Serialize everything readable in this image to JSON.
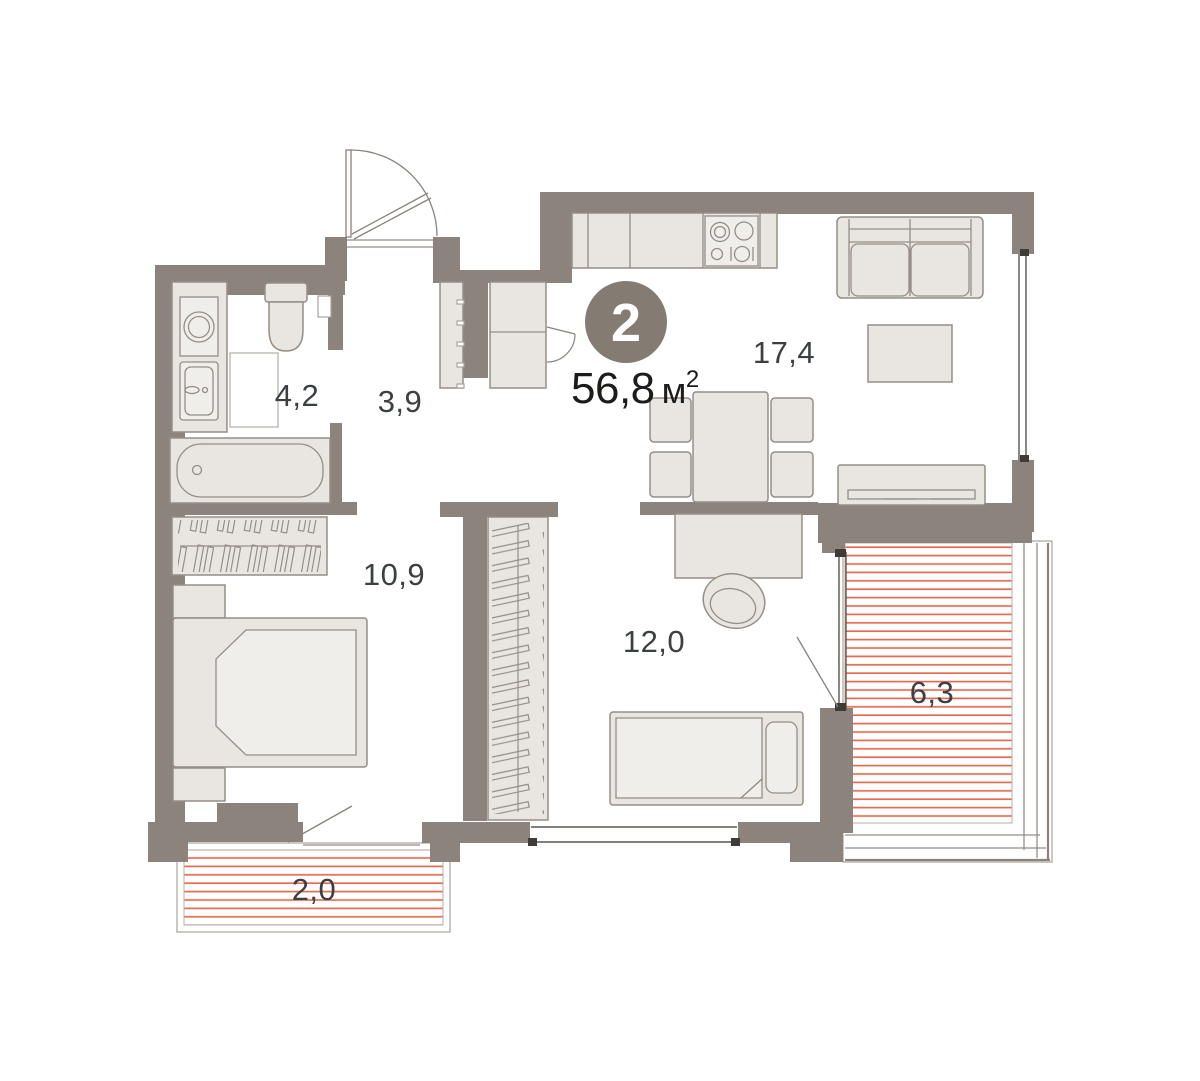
{
  "plan": {
    "badge": {
      "rooms": "2"
    },
    "area": {
      "value": "56,8",
      "unit": "м",
      "sup": "2"
    },
    "rooms": [
      {
        "name": "bathroom",
        "area": "4,2"
      },
      {
        "name": "hallway",
        "area": "3,9"
      },
      {
        "name": "bedroom",
        "area": "10,9"
      },
      {
        "name": "child-room",
        "area": "12,0"
      },
      {
        "name": "living-kitchen",
        "area": "17,4"
      },
      {
        "name": "balcony-right",
        "area": "6,3"
      },
      {
        "name": "balcony-bottom",
        "area": "2,0"
      }
    ],
    "colors": {
      "wall": "#8c847c",
      "furniture_fill": "#e9e6e2",
      "furniture_stroke": "#968e86",
      "balcony_stripe": "#e56a52",
      "badge_fill": "#847b73",
      "label_text": "#3c4042",
      "area_text": "#1c1c1a"
    }
  }
}
